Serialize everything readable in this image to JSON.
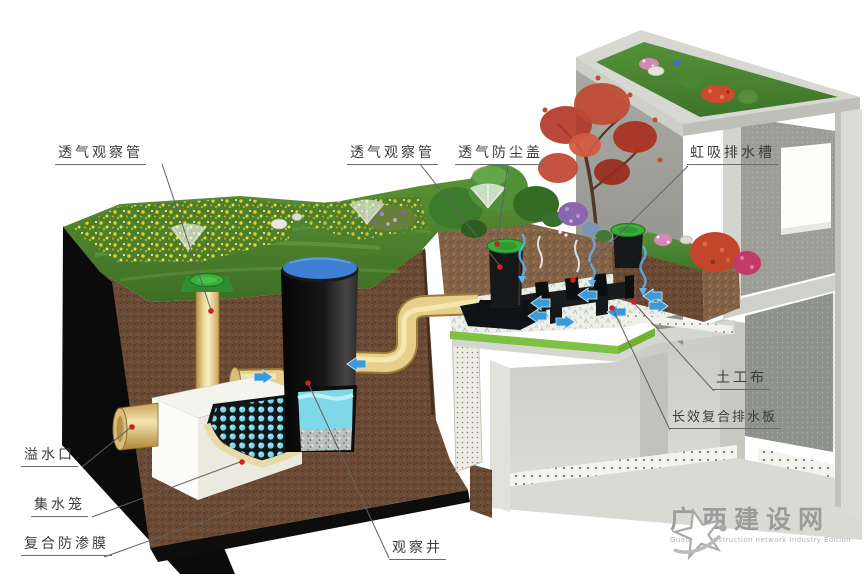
{
  "labels": {
    "vent_pipe_left": "透气观察管",
    "vent_pipe_mid": "透气观察管",
    "dust_cover": "透气防尘盖",
    "siphon_channel": "虹吸排水槽",
    "geotextile": "土工布",
    "drainage_board": "长效复合排水板",
    "overflow_port": "溢水口",
    "collection_cage": "集水笼",
    "impermeable_membrane": "复合防渗膜",
    "observation_well": "观察井"
  },
  "watermark": {
    "site_name": "广西建设网",
    "site_subtitle": "Guangxi construction network Industry Edition"
  },
  "colors": {
    "pipe_yellow": "#e9d48b",
    "cap_green": "#3cae3c",
    "well_top_blue": "#3d80d4",
    "water_cyan": "#7fd8e8",
    "board_green": "#7dc242",
    "soil_brown": "#6b4b35",
    "arrow_blue": "#3b9bd8",
    "leader_red_dot": "#cc2222",
    "label_text": "#3c3c3c",
    "watermark_gray": "#9b9b9b"
  }
}
